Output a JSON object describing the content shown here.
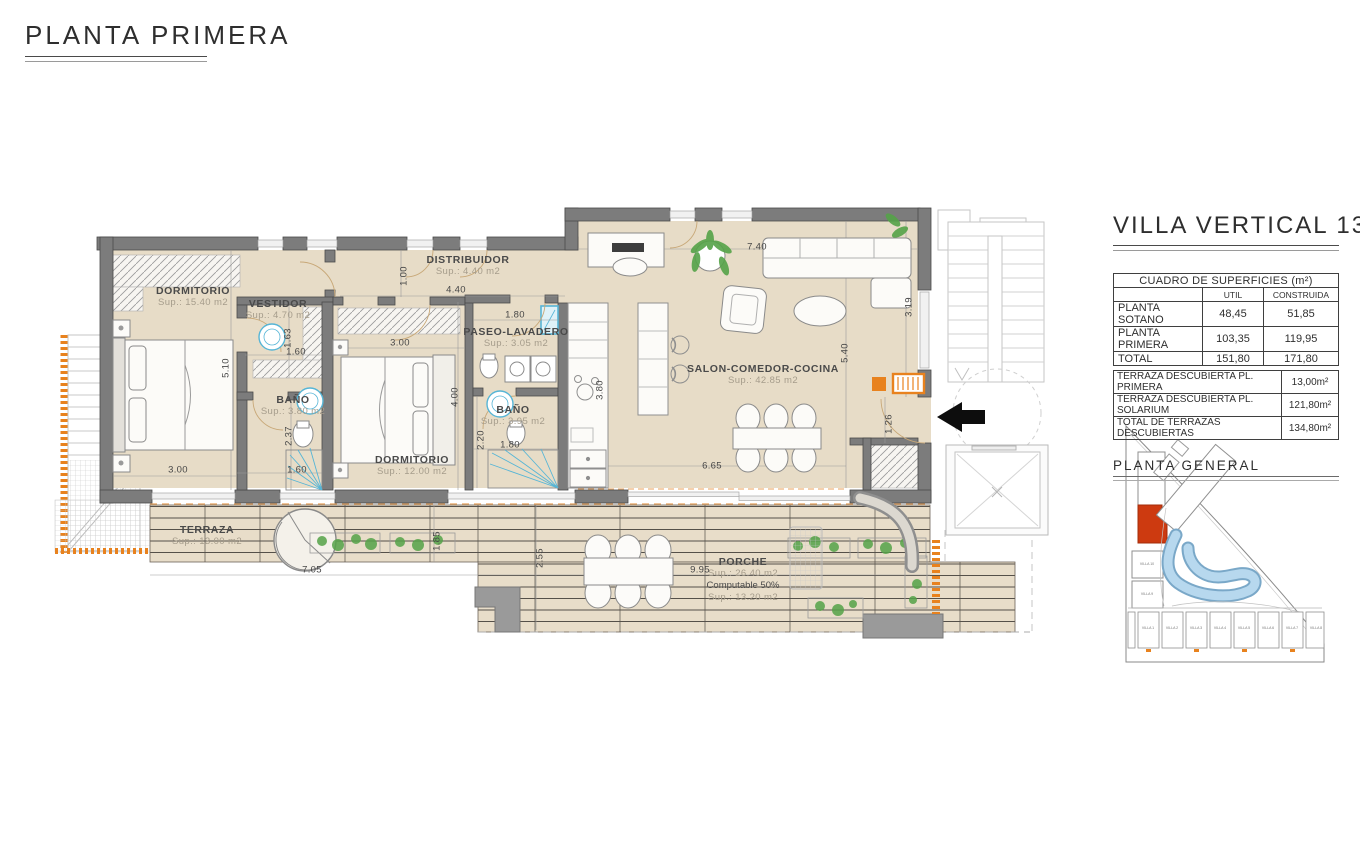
{
  "page": {
    "title": "PLANTA PRIMERA"
  },
  "plan": {
    "rooms": [
      {
        "id": "dormitorio-1",
        "name": "DORMITORIO",
        "sup": "Sup.: 15.40 m2",
        "x": 193,
        "y": 297
      },
      {
        "id": "vestidor",
        "name": "VESTIDOR",
        "sup": "Sup.: 4.70 m2",
        "x": 278,
        "y": 310
      },
      {
        "id": "bano-1",
        "name": "BAÑO",
        "sup": "Sup.: 3.80 m2",
        "x": 293,
        "y": 406
      },
      {
        "id": "dormitorio-2",
        "name": "DORMITORIO",
        "sup": "Sup.: 12.00 m2",
        "x": 412,
        "y": 466
      },
      {
        "id": "distribuidor",
        "name": "DISTRIBUIDOR",
        "sup": "Sup.: 4.40 m2",
        "x": 468,
        "y": 266
      },
      {
        "id": "paseo-lavadero",
        "name": "PASEO-LAVADERO",
        "sup": "Sup.: 3.05 m2",
        "x": 516,
        "y": 338
      },
      {
        "id": "bano-2",
        "name": "BAÑO",
        "sup": "Sup.: 3.95 m2",
        "x": 513,
        "y": 416
      },
      {
        "id": "salon-comedor-cocina",
        "name": "SALON-COMEDOR-COCINA",
        "sup": "Sup.: 42.85 m2",
        "x": 763,
        "y": 375
      },
      {
        "id": "terraza",
        "name": "TERRAZA",
        "sup": "Sup.: 13.00 m2",
        "x": 207,
        "y": 536
      },
      {
        "id": "porche",
        "name": "PORCHE",
        "sup": "Sup.: 26.40 m2",
        "extra1": "Computable 50%",
        "extra2": "Sup.: 13.20 m2",
        "x": 743,
        "y": 580
      }
    ],
    "dimensions": [
      {
        "t": "5.10",
        "x": 226,
        "y": 368,
        "v": true
      },
      {
        "t": "3.00",
        "x": 178,
        "y": 470,
        "v": false
      },
      {
        "t": "1.63",
        "x": 288,
        "y": 338,
        "v": true
      },
      {
        "t": "1.60",
        "x": 296,
        "y": 352,
        "v": false
      },
      {
        "t": "2.37",
        "x": 289,
        "y": 436,
        "v": true
      },
      {
        "t": "1.60",
        "x": 297,
        "y": 470,
        "v": false
      },
      {
        "t": "3.00",
        "x": 400,
        "y": 343,
        "v": false
      },
      {
        "t": "1.80",
        "x": 515,
        "y": 315,
        "v": false
      },
      {
        "t": "1.00",
        "x": 404,
        "y": 276,
        "v": true
      },
      {
        "t": "4.40",
        "x": 456,
        "y": 290,
        "v": false
      },
      {
        "t": "4.00",
        "x": 455,
        "y": 397,
        "v": true
      },
      {
        "t": "3.80",
        "x": 600,
        "y": 390,
        "v": true
      },
      {
        "t": "2.20",
        "x": 481,
        "y": 440,
        "v": true
      },
      {
        "t": "1.80",
        "x": 510,
        "y": 445,
        "v": false
      },
      {
        "t": "7.40",
        "x": 757,
        "y": 247,
        "v": false
      },
      {
        "t": "3.19",
        "x": 909,
        "y": 307,
        "v": true
      },
      {
        "t": "5.40",
        "x": 845,
        "y": 353,
        "v": true
      },
      {
        "t": "1.26",
        "x": 889,
        "y": 424,
        "v": true
      },
      {
        "t": "6.65",
        "x": 712,
        "y": 466,
        "v": false
      },
      {
        "t": "7.05",
        "x": 312,
        "y": 570,
        "v": false
      },
      {
        "t": "1.85",
        "x": 437,
        "y": 541,
        "v": true
      },
      {
        "t": "9.95",
        "x": 700,
        "y": 570,
        "v": false
      },
      {
        "t": "2.55",
        "x": 540,
        "y": 558,
        "v": true
      }
    ]
  },
  "panel": {
    "title": "VILLA VERTICAL 13",
    "surfaces_table": {
      "title": "CUADRO DE SUPERFICIES (m²)",
      "columns": [
        "UTIL",
        "CONSTRUIDA"
      ],
      "rows": [
        {
          "label": "PLANTA SOTANO",
          "util": "48,45",
          "construida": "51,85"
        },
        {
          "label": "PLANTA PRIMERA",
          "util": "103,35",
          "construida": "119,95"
        },
        {
          "label": "TOTAL",
          "util": "151,80",
          "construida": "171,80"
        }
      ]
    },
    "terraces_table": {
      "rows": [
        {
          "label": "TERRAZA DESCUBIERTA PL. PRIMERA",
          "value": "13,00m²"
        },
        {
          "label": "TERRAZA DESCUBIERTA PL. SOLARIUM",
          "value": "121,80m²"
        },
        {
          "label": "TOTAL DE TERRAZAS DESCUBIERTAS",
          "value": "134,80m²"
        }
      ]
    },
    "site_plan": {
      "label": "PLANTA  GENERAL",
      "left_villas": [
        "VILLA 10",
        "VILLA 9"
      ],
      "bottom_villas": [
        "VILLA 1",
        "VILLA 2",
        "VILLA 3",
        "VILLA 4",
        "VILLA 5",
        "VILLA 6",
        "VILLA 7",
        "VILLA 8"
      ]
    }
  },
  "colors": {
    "accent_orange": "#e8821e",
    "highlight_red": "#cd3a10",
    "fixture_blue": "#56b5d6",
    "floor_beige": "#e7dcc7",
    "wall_gray": "#7c7c7c",
    "pool_blue": "#a9d0e8",
    "plant_green": "#55a348"
  }
}
